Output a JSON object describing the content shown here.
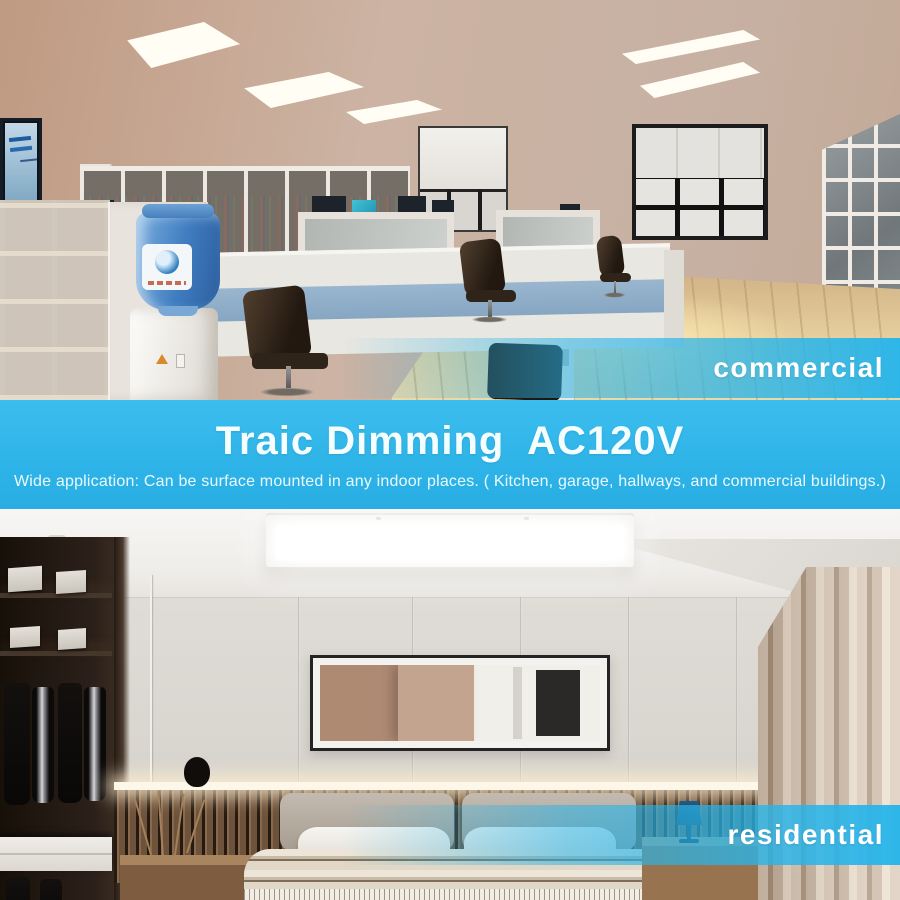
{
  "banner": {
    "title": "Traic Dimming  AC120V",
    "subtitle": "Wide application: Can be surface mounted in any indoor places. ( Kitchen, garage, hallways, and commercial buildings.)",
    "background_color": "#2fb5ea",
    "text_color": "#ffffff"
  },
  "scene_labels": {
    "commercial": "commercial",
    "residential": "residential"
  },
  "scenes": {
    "commercial": {
      "alt": "office interior lit by recessed LED panel ceiling lights"
    },
    "residential": {
      "alt": "bedroom interior lit by a surface-mounted linear LED ceiling light"
    }
  },
  "colors": {
    "accent_cyan": "#2fb5ea",
    "label_band_cyan": "#29b4e8",
    "label_text_color": "#ffffff"
  }
}
